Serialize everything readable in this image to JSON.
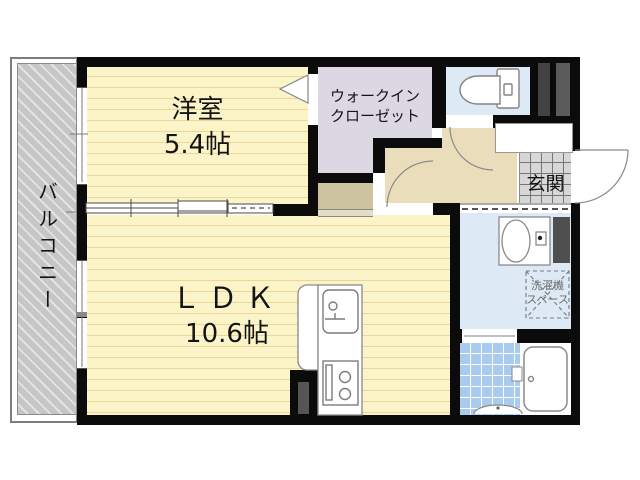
{
  "floor_plan": {
    "balcony": {
      "label": "バルコニー"
    },
    "western_room": {
      "label": "洋室",
      "size": "5.4帖"
    },
    "walk_in_closet": {
      "label_line1": "ウォークイン",
      "label_line2": "クローゼット"
    },
    "ldk": {
      "label": "ＬＤＫ",
      "size": "10.6帖"
    },
    "entrance": {
      "label": "玄関"
    },
    "washer_space": {
      "label_line1": "洗濯機",
      "label_line2": "スペース"
    },
    "fixtures": [
      "toilet",
      "washbasin",
      "bathtub",
      "shower-counter",
      "kitchen-sink",
      "stove",
      "washing-machine-space"
    ],
    "colors": {
      "wall_black": "#0b0b0b",
      "room_yellow": "#fcf4c9",
      "room_yellow_stripe": "#ecd69a",
      "closet_lavender": "#dbd7e3",
      "hallway_beige": "#e9ddbb",
      "alcove_tan": "#cdc3a0",
      "water_area_blue": "#dde9f5",
      "bath_tile_blue": "#a9cbee",
      "entrance_tile_gray": "#d7d7d7",
      "balcony_gray": "#c6c6c6",
      "pipe_space_gray": "#4d4d4d"
    }
  }
}
